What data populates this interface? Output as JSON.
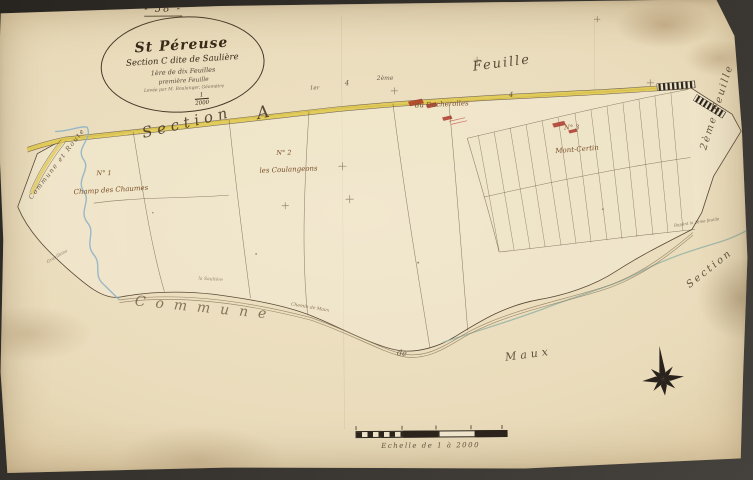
{
  "page": {
    "sheet_number": "- 58 -"
  },
  "cartouche": {
    "commune": "St Péreuse",
    "section_line": "Section C dite de Saulière",
    "line3": "1ère de dix Feuilles",
    "line4": "première Feuille",
    "surveyor_line": "Levée par M. Boulanger, Géomètre",
    "scale_numerator": "1",
    "scale_denominator": "2000"
  },
  "neighbor_labels": {
    "section_word_top": "Section",
    "section_letter_top": "A",
    "feuille_top": "Feuille",
    "feuille_right": "2ème Feuille",
    "section_bottom_right": "Section",
    "commune_bottom": "Commune",
    "de_bottom": "de",
    "maux_bottom": "Maux",
    "commune_route_left": "Commune et Route",
    "rejoint_note": "Rejoint la 2ème feuille"
  },
  "sheet_marks": {
    "m1": "1er",
    "m2": "4",
    "m3": "2ème",
    "m4": "4"
  },
  "parcel_labels": {
    "n1_number": "N° 1",
    "n1_name": "Champ des Chaumes",
    "n2_number": "N° 2",
    "n2_name": "les Coulangeons",
    "n3_number": "N° 3",
    "n3_name": "Mont-Certin",
    "hamlet": "du Ducherolles",
    "chemin": "Chemin de Maux",
    "tiny_left": "Gravillons",
    "tiny_center": "la Saulière"
  },
  "scale_bar": {
    "caption": "Echelle de 1 à 2000"
  },
  "colors": {
    "road_yellow": "#e0c94f",
    "stream_blue": "#8fb3c7",
    "stream_green": "#96b3a4",
    "building_red": "#a93226",
    "ink": "#4a3a28"
  }
}
